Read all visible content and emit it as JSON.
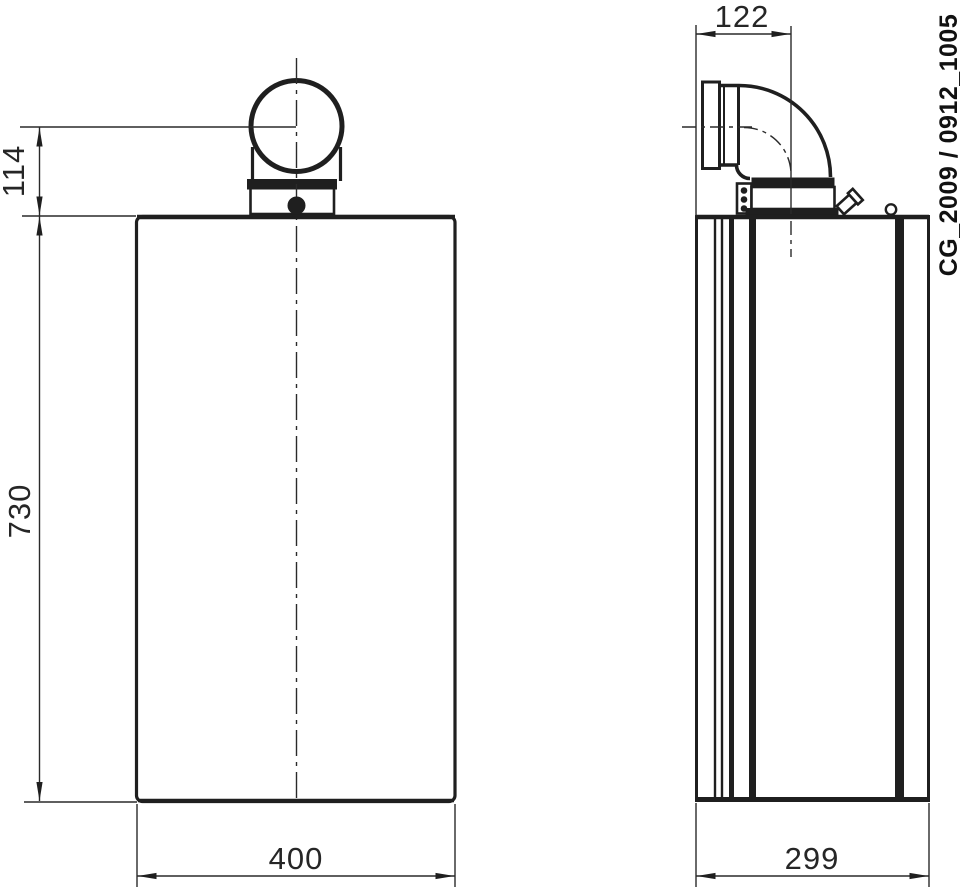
{
  "views": {
    "front": {
      "dimensions": {
        "width": {
          "value": "400"
        },
        "height": {
          "value": "730"
        },
        "flue_center_offset": {
          "value": "114"
        }
      }
    },
    "side": {
      "dimensions": {
        "depth": {
          "value": "299"
        },
        "flue_center_offset": {
          "value": "122"
        }
      }
    }
  },
  "annotation": {
    "document_code": "CG_2009 / 0912_1005"
  },
  "colors": {
    "line": "#1f1f1f",
    "dimension_text": "#262626",
    "background": "#ffffff"
  }
}
